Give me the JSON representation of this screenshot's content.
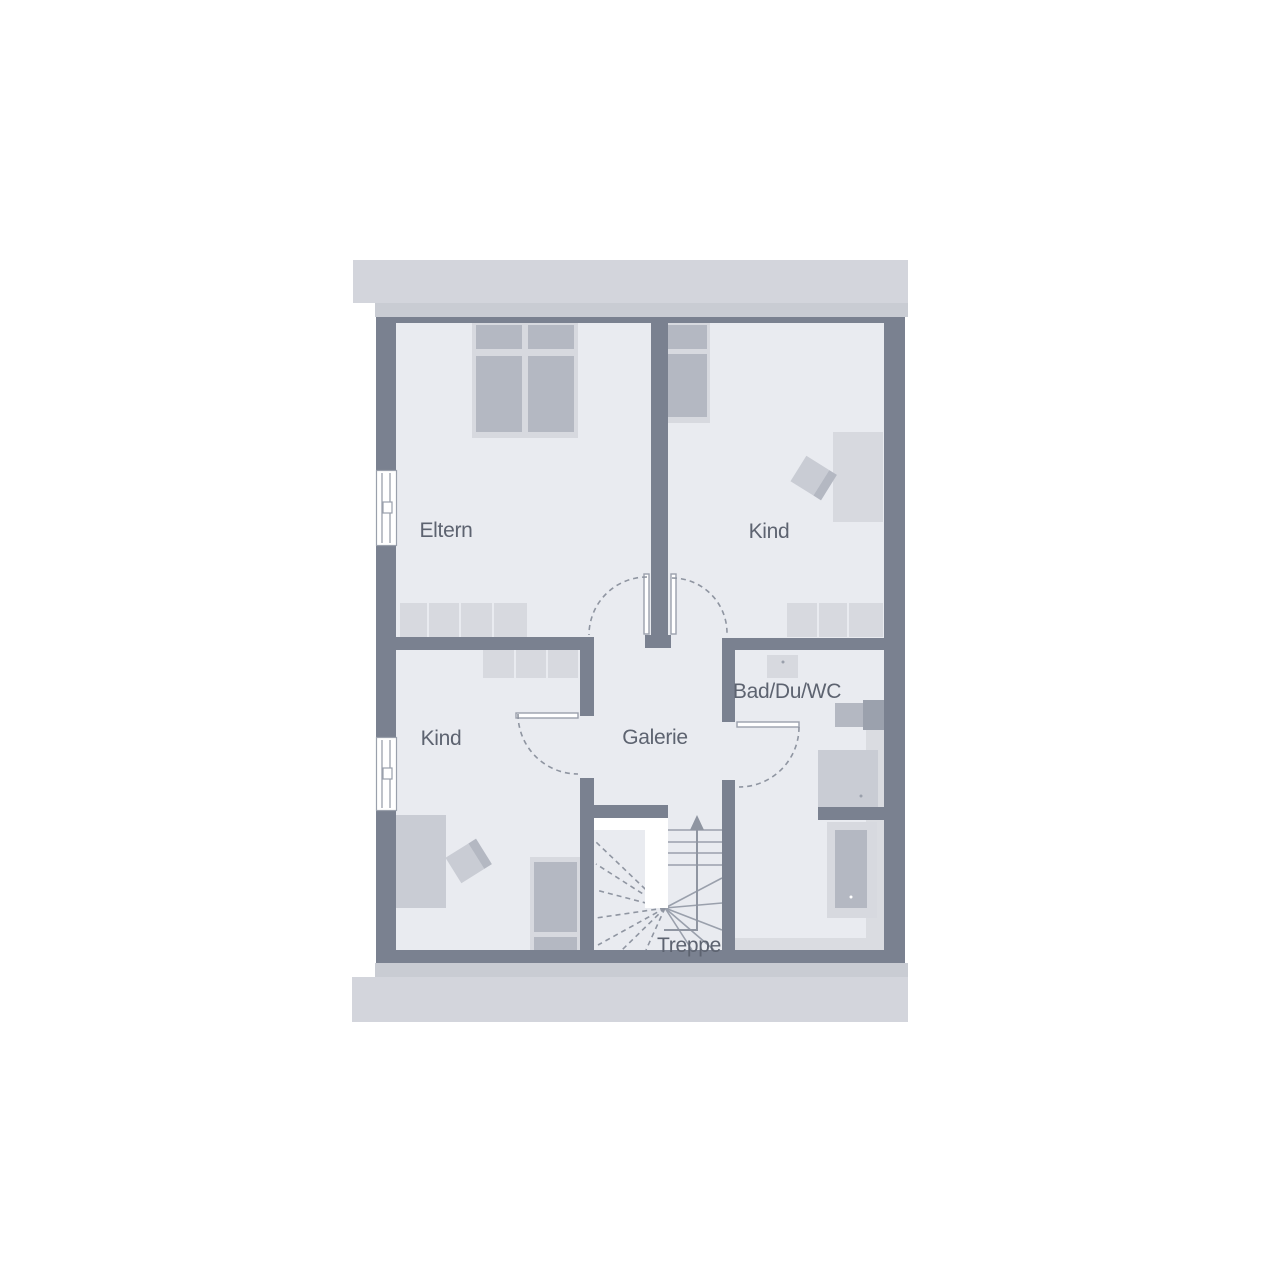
{
  "floorplan": {
    "labels": {
      "eltern": "Eltern",
      "kind_top": "Kind",
      "kind_bottom": "Kind",
      "galerie": "Galerie",
      "bad": "Bad/Du/WC",
      "treppe": "Treppe"
    },
    "colors": {
      "wall": "#7a8190",
      "pier": "#9ba1ad",
      "floor": "#e9ebf0",
      "band_light": "#d3d5dc",
      "band_mid": "#c9ccd3",
      "furniture_light": "#d7d9df",
      "furniture_mid": "#c9ccd4",
      "furniture_dark": "#b4b8c2",
      "strip": "#dadce1",
      "line": "#9aa0ac",
      "dash": "#8f95a1",
      "text": "#5d6370"
    }
  }
}
